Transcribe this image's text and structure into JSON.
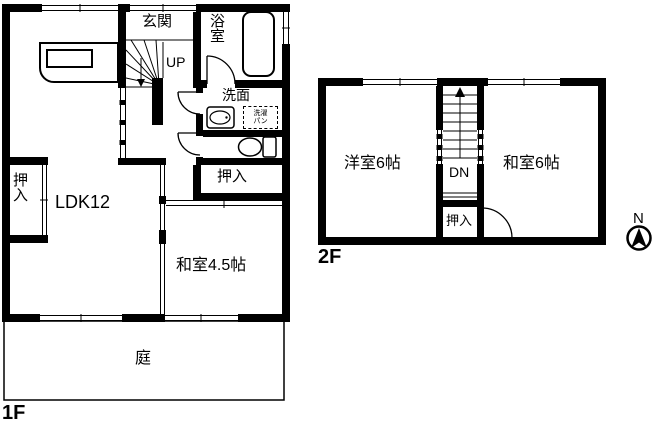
{
  "colors": {
    "line": "#000000",
    "background": "#ffffff"
  },
  "floor1": {
    "name_label": "1F",
    "rooms": {
      "entrance": "玄関",
      "bathroom": "浴室",
      "stairs_up": "UP",
      "washroom": "洗面",
      "laundry_pan_line1": "洗濯",
      "laundry_pan_line2": "パン",
      "closet_left": "押入",
      "closet_right": "押入",
      "living": "LDK12",
      "japanese_room": "和室4.5帖",
      "garden": "庭"
    }
  },
  "floor2": {
    "name_label": "2F",
    "rooms": {
      "western_room": "洋室6帖",
      "japanese_room": "和室6帖",
      "stairs_down": "DN",
      "closet": "押入"
    }
  },
  "compass": {
    "north": "N"
  }
}
